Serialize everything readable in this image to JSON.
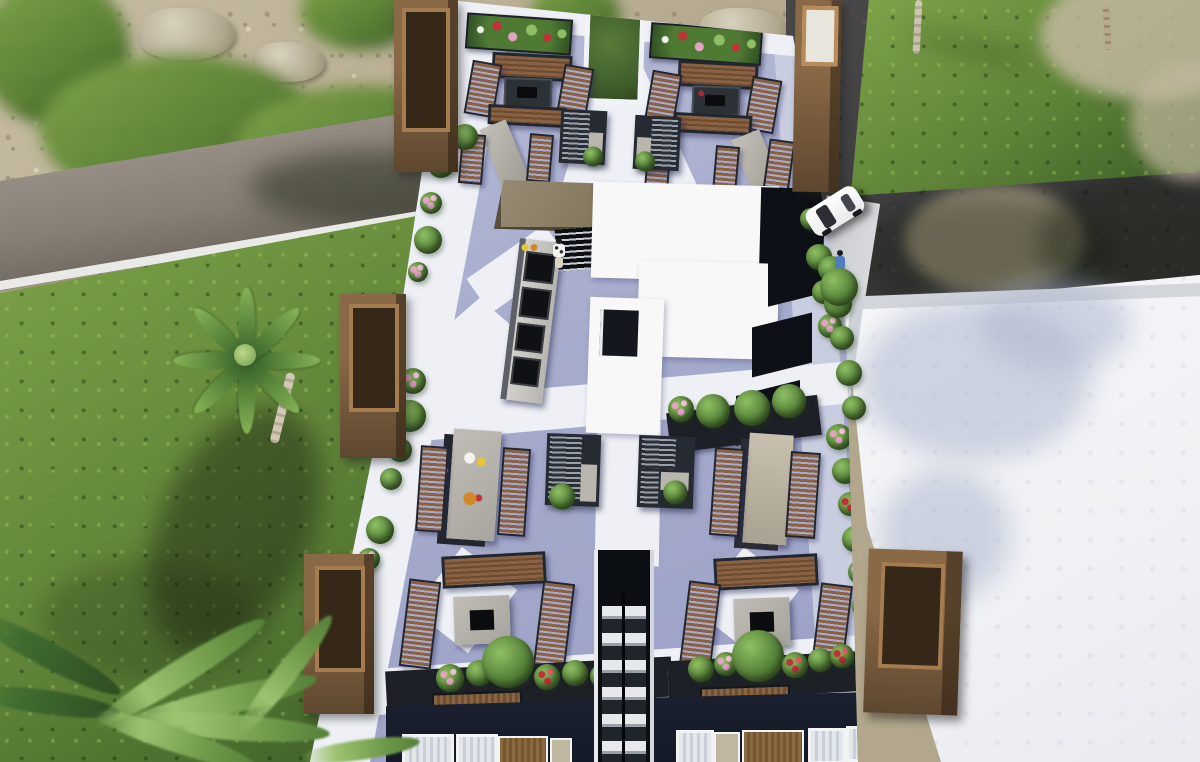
{
  "image": {
    "width": 1200,
    "height": 762,
    "kind": "3d-architectural-aerial-render",
    "subject": "rooftop-amenity-terrace"
  },
  "palette": {
    "sand": "#b2a78c",
    "sandLight": "#c6bca2",
    "sandDark": "#9c9177",
    "rock": "#d8d1bd",
    "grass": "#5f8338",
    "grassLight": "#7fa449",
    "grassDark": "#3a5a26",
    "roadLeft": "#867f76",
    "curb": "#e9e9e7",
    "asphalt": "#3e3d3f",
    "walkGray": "#d8d9dc",
    "roofWhite": "#eff1f4",
    "roofParapet": "#d3d6db",
    "deck": "#a7accd",
    "pathWhite": "#eef0f6",
    "wood": "#8a6142",
    "woodDark": "#6b4a2f",
    "frameDark": "#23262d",
    "towerFace": "#8a6947",
    "towerSide": "#5e472f",
    "towerInner": "#362818",
    "canopy": "#85795f",
    "stone": "#a6a39c",
    "penthouse": "#f8f8f9",
    "black": "#0d1016",
    "navy": "#141926",
    "sofaDark": "#262a32",
    "sofaStripe": "#99a0aa",
    "planterDark": "#1d2026",
    "leaf": "#4f7a34",
    "leafLight": "#8fbf63",
    "flowerPink": "#e3a4c2",
    "flowerRed": "#c03138",
    "flowerWhite": "#eff1e8",
    "carWhite": "#ffffff",
    "shirtBlue": "#4d7fc0"
  },
  "scene": {
    "ground": [
      "rocky-sand-terrain",
      "lawn",
      "left-paved-road-with-curb",
      "right-asphalt-road",
      "side-walkway"
    ],
    "buildings": [
      "rooftop-terrace-building",
      "adjacent-white-flat-roof-building",
      "street-facade-with-windows"
    ],
    "terrace_features": [
      "corner-wood-planter-towers",
      "upper-fire-pit-lounges",
      "lower-fire-pit-lounges",
      "wood-benches",
      "sun-loungers",
      "l-shaped-sofas",
      "outdoor-kitchen-with-grills",
      "bar-canopy",
      "louvered-pergola",
      "dining-table-with-food",
      "stair-access-shaft",
      "white-penthouse-volume",
      "central-courtyard-lightwell",
      "perimeter-flower-planters"
    ],
    "vegetation": [
      "palm-tree",
      "foreground-palm-fronds",
      "shrub-rows",
      "flower-planters",
      "street-trees"
    ],
    "figures": [
      "person-at-bar",
      "person-dining",
      "pedestrian-on-road"
    ],
    "vehicles": [
      "white-car-parked"
    ]
  }
}
